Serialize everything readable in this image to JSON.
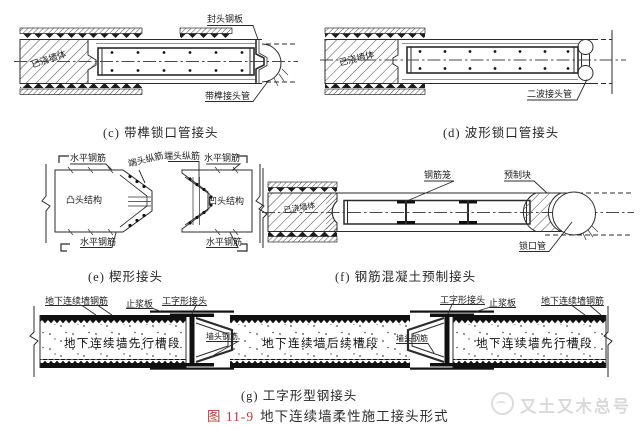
{
  "figure": {
    "number": "图 11-9",
    "title": "地下连续墙柔性施工接头形式",
    "watermark_text": "又土又木总号"
  },
  "captions": {
    "c": "(c) 带榫锁口管接头",
    "d": "(d) 波形锁口管接头",
    "e": "(e) 楔形接头",
    "f": "(f) 钢筋混凝土预制接头",
    "g": "(g) 工字形型钢接头"
  },
  "labels": {
    "seal_head_plate": "封头钢板",
    "poured_wall": "已浇墙体",
    "tenon_joint_pipe": "带榫接头管",
    "two_wave_joint_pipe": "二波接头管",
    "horizontal_rebar": "水平钢筋",
    "end_longitudinal_rebar": "端头纵筋",
    "convex_head_structure": "凸头结构",
    "concave_head_structure": "凹头结构",
    "rebar_cage": "钢筋笼",
    "precast_block": "预制块",
    "lock_pipe": "锁口管",
    "wall_rebar": "地下连续墙钢筋",
    "grout_stop_plate": "止浆板",
    "i_shaped_joint": "工字形接头",
    "wall_head_rebar": "墙头钢筋",
    "leading_panel": "地下连续墙先行槽段",
    "subsequent_panel": "地下连续墙后续槽段"
  },
  "colors": {
    "line": "#2b2b2b",
    "figure_number_red": "#bf3b36",
    "watermark_gray": "#d9d9d9"
  }
}
